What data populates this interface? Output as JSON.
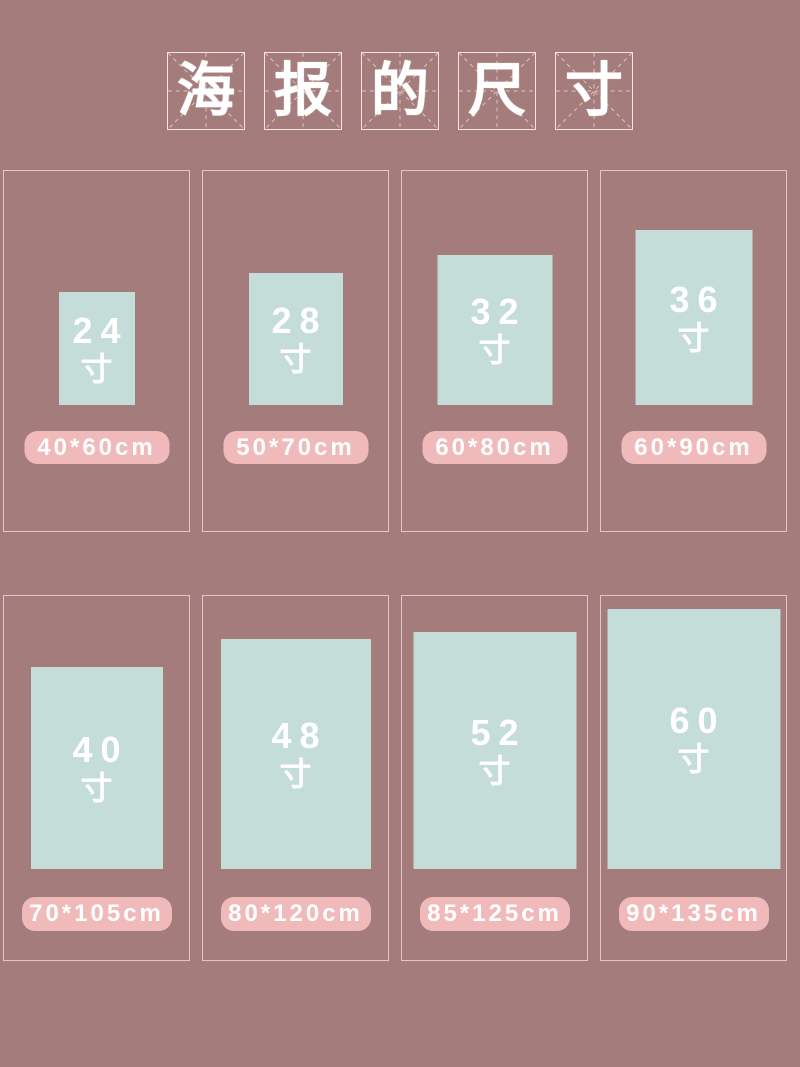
{
  "page": {
    "background": "#a47c7c",
    "rect_color": "#c5ddd8",
    "pill_color": "#f0baba",
    "border_color": "rgba(245,225,225,0.75)",
    "text_color": "#ffffff"
  },
  "title": {
    "text": "海报的尺寸",
    "chars": [
      "海",
      "报",
      "的",
      "尺",
      "寸"
    ]
  },
  "cards": [
    {
      "inches": "24",
      "unit": "寸",
      "cm": "40*60cm",
      "rect": {
        "w": 76,
        "h": 113
      }
    },
    {
      "inches": "28",
      "unit": "寸",
      "cm": "50*70cm",
      "rect": {
        "w": 94,
        "h": 132
      }
    },
    {
      "inches": "32",
      "unit": "寸",
      "cm": "60*80cm",
      "rect": {
        "w": 115,
        "h": 150
      }
    },
    {
      "inches": "36",
      "unit": "寸",
      "cm": "60*90cm",
      "rect": {
        "w": 117,
        "h": 175
      }
    },
    {
      "inches": "40",
      "unit": "寸",
      "cm": "70*105cm",
      "rect": {
        "w": 132,
        "h": 202
      }
    },
    {
      "inches": "48",
      "unit": "寸",
      "cm": "80*120cm",
      "rect": {
        "w": 150,
        "h": 230
      }
    },
    {
      "inches": "52",
      "unit": "寸",
      "cm": "85*125cm",
      "rect": {
        "w": 163,
        "h": 237
      }
    },
    {
      "inches": "60",
      "unit": "寸",
      "cm": "90*135cm",
      "rect": {
        "w": 173,
        "h": 260
      }
    }
  ]
}
